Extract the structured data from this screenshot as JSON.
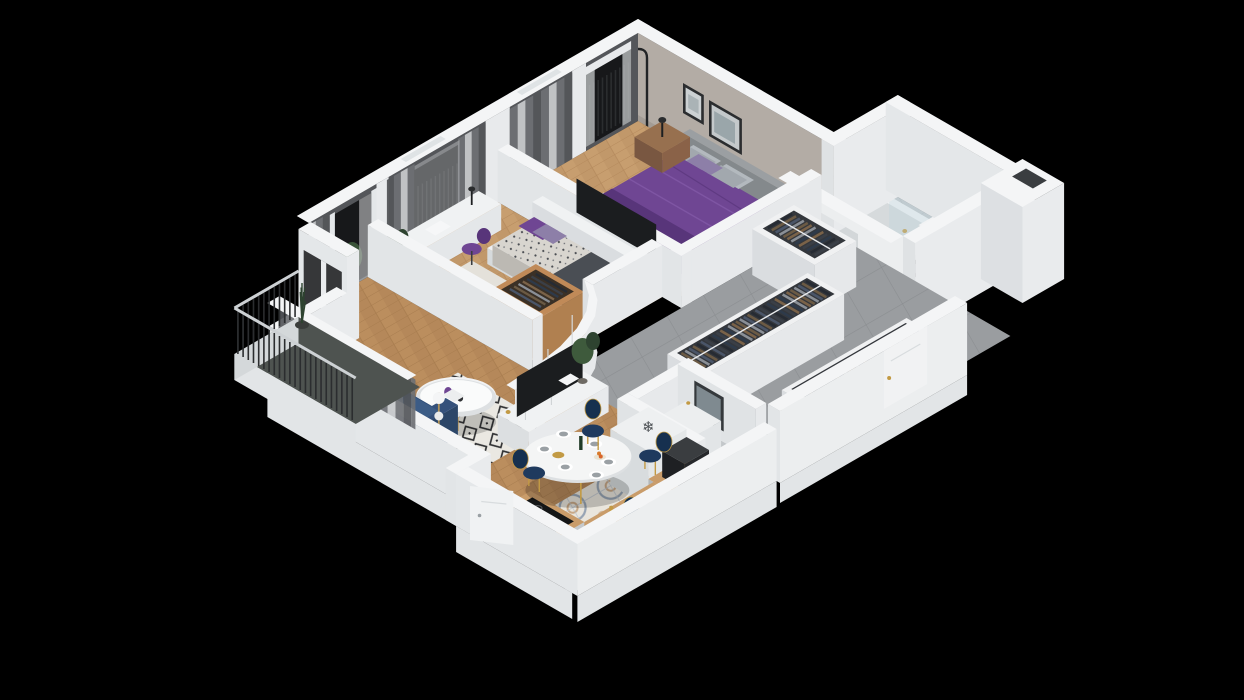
{
  "scene": {
    "name": "isometric-apartment-floorplan-3d-render",
    "type": "3d-cutaway-floor-plan",
    "background": "#000000",
    "rooms": [
      {
        "name": "master-bedroom",
        "items": [
          "double-bed-purple-duvet",
          "gray-pillows",
          "headboard",
          "nightstand",
          "table-lamp",
          "arc-floor-lamp",
          "wall-art-frames",
          "white-rug",
          "wood-floor",
          "curtains",
          "french-balcony-railing"
        ]
      },
      {
        "name": "kids-room",
        "items": [
          "daybed",
          "patterned-mattress",
          "purple-pillows",
          "dark-blanket",
          "desk",
          "desk-lamp",
          "purple-chair",
          "wood-wardrobe",
          "rug",
          "curtains"
        ]
      },
      {
        "name": "living-room",
        "items": [
          "navy-sofa",
          "geometric-rug",
          "round-coffee-table",
          "purple-vase",
          "tv-console",
          "tv",
          "floor-lamp",
          "potted-plant",
          "curtains",
          "herringbone-floor"
        ]
      },
      {
        "name": "dining-area",
        "items": [
          "oval-white-table",
          "navy-velvet-chairs",
          "plates",
          "wine-bottle",
          "fruit-bowl"
        ]
      },
      {
        "name": "kitchen",
        "items": [
          "fridge-snowflake",
          "coffee-machine",
          "gray-cabinets",
          "wood-countertop",
          "sink",
          "gold-faucet",
          "induction-cooktop",
          "storage-jars",
          "patterned-cement-tile",
          "white-door"
        ]
      },
      {
        "name": "bathroom",
        "items": [
          "bathtub",
          "glass-screen",
          "vanity-sink",
          "washing-machine",
          "round-gold-mirror",
          "oval-gold-mirror",
          "herringbone-tile-walls",
          "white-door"
        ]
      },
      {
        "name": "hallway",
        "items": [
          "gray-tile-floor",
          "open-wardrobe-racks",
          "hanging-clothes",
          "white-doors",
          "curved-wall"
        ]
      },
      {
        "name": "powder-room",
        "items": [
          "vanity-sink",
          "mirror",
          "towel"
        ]
      },
      {
        "name": "balcony",
        "items": [
          "metal-railing",
          "vertical-bars",
          "potted-grass-plant",
          "concrete-floor"
        ]
      }
    ],
    "icons": [
      {
        "name": "snowflake-icon",
        "glyph": "❄"
      }
    ],
    "colors": {
      "bg": "#000000",
      "wallTop": "#f4f5f6",
      "wallFace": "#e9ebed",
      "wallShade": "#d6dade",
      "wallDark": "#c7ccd0",
      "plinth": "#e2e5e7",
      "intBeige": "#b3aca5",
      "intBeigeDark": "#a39c95",
      "curtainDark": "#54565a",
      "curtainMid": "#6e7074",
      "curtainSheer": "#c6c8ca",
      "windowDark": "#17181a",
      "barDark": "#2b2d2f",
      "wood": "#bb8e5e",
      "woodLine": "#a87d4f",
      "woodLight": "#c79e6f",
      "tileHall": "#9a9da0",
      "tileHallLine": "#8b8e91",
      "bathFloor": "#c3c7ca",
      "bathWall": "#b4b6b8",
      "bathWallLine": "#a5a7a9",
      "powderFloor": "#b7bec5",
      "kitchTileBase": "#e9e5dc",
      "kitchTileInk": "#97a4b4",
      "kitchTileTan": "#c8a886",
      "rugWhite": "#eae8e2",
      "rugBlack": "#2f3032",
      "rugPlain": "#e4e1da",
      "purple": "#6f4693",
      "purpleDark": "#58357a",
      "pillow": "#b3b9be",
      "pillow2": "#a2a8ae",
      "bedWhite": "#eef0f2",
      "headboard": "#8f9497",
      "mattress": "#d8d5cf",
      "navy": "#2e4c76",
      "navyDark": "#223a5e",
      "navyLight": "#3c5c86",
      "chairNavy": "#1f3a5e",
      "gold": "#c29a44",
      "tvDark": "#1b1d1f",
      "plantGreen": "#3e5a3c",
      "plantDark": "#2e4330",
      "counterGray": "#c5c9cc",
      "counterGrayDark": "#b2b7ba",
      "counterWood": "#c99c6a",
      "fridgeWhite": "#eef0f1",
      "applianceDark": "#26282b",
      "cooktop": "#141617",
      "sinkWhite": "#f2f3f4",
      "tubInner": "#d6dadc",
      "glass": "#bcd3dc",
      "mirror": "#9fb0b6",
      "balconyFloor": "#4e5350",
      "railTop": "#cdd1d4",
      "brown": "#8a6248",
      "woodWard": "#b08050",
      "clothes_palette": [
        "#2e3a4a",
        "#6b5a44",
        "#3a3f47",
        "#8a8f96",
        "#262b33",
        "#7a6248",
        "#4a5568"
      ]
    }
  }
}
